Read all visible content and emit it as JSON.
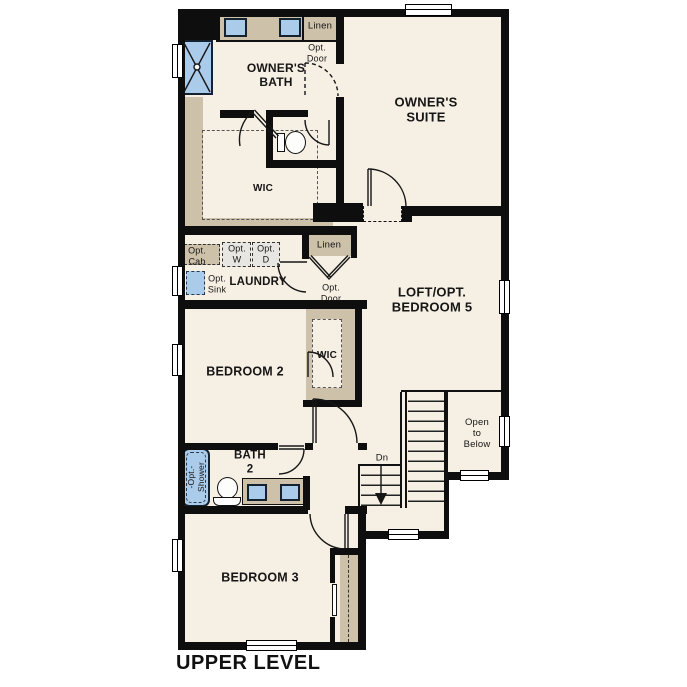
{
  "title": "UPPER LEVEL",
  "colors": {
    "floor": "#f6efe3",
    "wall": "#0e0e0e",
    "wood": "#cdc1a9",
    "fixture": "#abcbea",
    "optbox": "#e7e6e2"
  },
  "rooms": {
    "owners_bath": "OWNER'S\nBATH",
    "owners_suite": "OWNER'S\nSUITE",
    "owners_wic": "WIC",
    "laundry": "LAUNDRY",
    "loft": "LOFT/OPT.\nBEDROOM 5",
    "bedroom2": "BEDROOM 2",
    "bedroom2_wic": "WIC",
    "bath2": "BATH\n2",
    "bedroom3": "BEDROOM 3"
  },
  "labels": {
    "linen_upper": "Linen",
    "opt_door_upper": "Opt.\nDoor",
    "opt_cab": "Opt.\nCab",
    "opt_washer": "Opt.\nW",
    "opt_dryer": "Opt.\nD",
    "opt_sink": "Opt.\nSink",
    "linen_hall": "Linen",
    "opt_door_hall": "Opt.\nDoor",
    "opt_shower": "-Opt.-\nShower",
    "stairs_down": "Dn",
    "open_to_below": "Open\nto\nBelow"
  }
}
